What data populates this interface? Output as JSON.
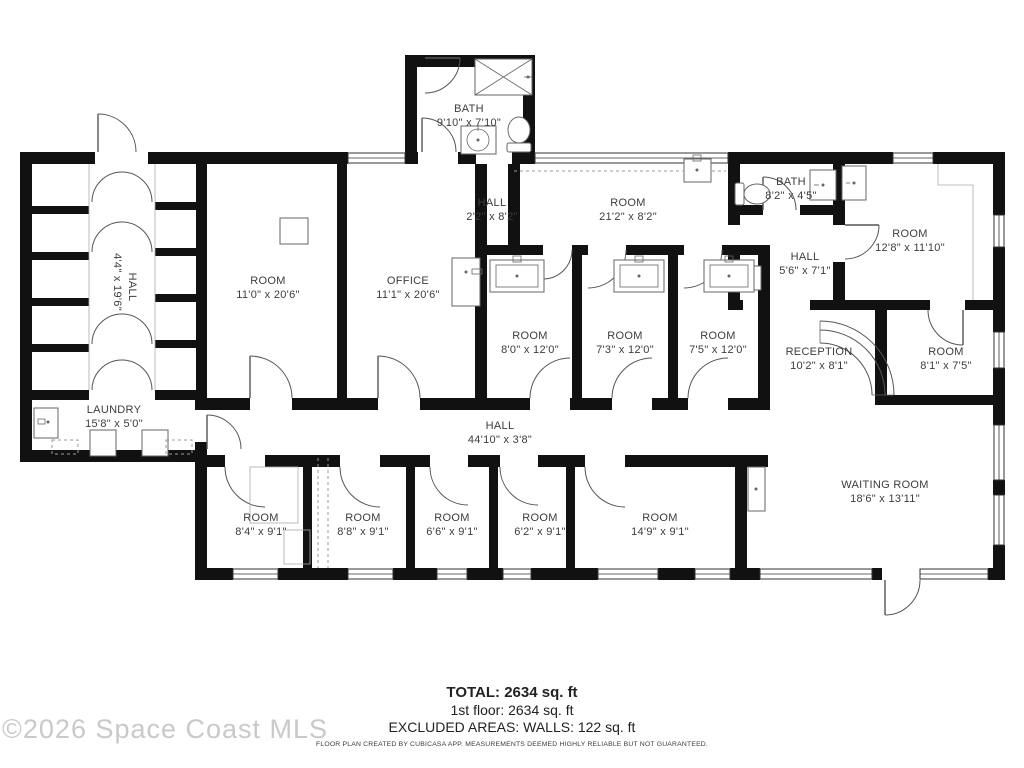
{
  "watermark": "©2026 Space Coast MLS",
  "footer": {
    "total": "TOTAL: 2634 sq. ft",
    "floor": "1st floor: 2634 sq. ft",
    "excluded": "EXCLUDED AREAS: WALLS: 122 sq. ft",
    "disclaimer": "FLOOR PLAN CREATED BY CUBICASA APP. MEASUREMENTS DEEMED HIGHLY RELIABLE BUT NOT GUARANTEED."
  },
  "rooms": {
    "bath_top": {
      "name": "BATH",
      "dims": "9'10\" x 7'10\""
    },
    "hall_top": {
      "name": "HALL",
      "dims": "2'2\" x 8'2\""
    },
    "room_top": {
      "name": "ROOM",
      "dims": "21'2\" x 8'2\""
    },
    "bath_right": {
      "name": "BATH",
      "dims": "8'2\" x 4'5\""
    },
    "room_right_top": {
      "name": "ROOM",
      "dims": "12'8\" x 11'10\""
    },
    "hall_right": {
      "name": "HALL",
      "dims": "5'6\" x 7'1\""
    },
    "room_left": {
      "name": "ROOM",
      "dims": "11'0\" x 20'6\""
    },
    "office": {
      "name": "OFFICE",
      "dims": "11'1\" x 20'6\""
    },
    "room_mid_1": {
      "name": "ROOM",
      "dims": "8'0\" x 12'0\""
    },
    "room_mid_2": {
      "name": "ROOM",
      "dims": "7'3\" x 12'0\""
    },
    "room_mid_3": {
      "name": "ROOM",
      "dims": "7'5\" x 12'0\""
    },
    "reception": {
      "name": "RECEPTION",
      "dims": "10'2\" x 8'1\""
    },
    "room_right_mid": {
      "name": "ROOM",
      "dims": "8'1\" x 7'5\""
    },
    "hall_vertical": {
      "name": "HALL",
      "dims": "4'4\" x 19'6\""
    },
    "laundry": {
      "name": "LAUNDRY",
      "dims": "15'8\" x 5'0\""
    },
    "hall_main": {
      "name": "HALL",
      "dims": "44'10\" x 3'8\""
    },
    "room_b1": {
      "name": "ROOM",
      "dims": "8'4\" x 9'1\""
    },
    "room_b2": {
      "name": "ROOM",
      "dims": "8'8\" x 9'1\""
    },
    "room_b3": {
      "name": "ROOM",
      "dims": "6'6\" x 9'1\""
    },
    "room_b4": {
      "name": "ROOM",
      "dims": "6'2\" x 9'1\""
    },
    "room_b5": {
      "name": "ROOM",
      "dims": "14'9\" x 9'1\""
    },
    "waiting": {
      "name": "WAITING ROOM",
      "dims": "18'6\" x 13'11\""
    }
  },
  "colors": {
    "wall": "#111111",
    "label": "#3c3c3c",
    "watermark": "#c9c9c9"
  }
}
